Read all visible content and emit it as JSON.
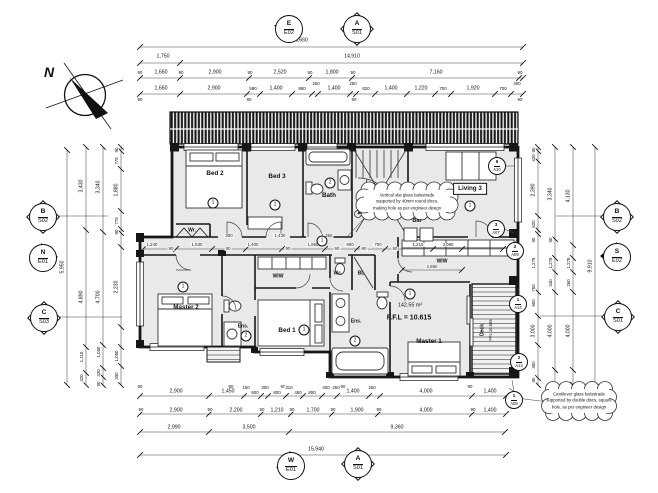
{
  "colors": {
    "paper": "#ffffff",
    "floor": "#e9eae8",
    "wall": "#161616",
    "dimline": "#444444"
  },
  "north_arrow": {
    "letter": "N"
  },
  "room_labels": [
    {
      "t": "N",
      "x": 49,
      "y": 72,
      "c": "north"
    },
    {
      "t": "Bed 2",
      "x": 215,
      "y": 174
    },
    {
      "t": "Bed 3",
      "x": 277,
      "y": 177
    },
    {
      "t": "Bath",
      "x": 329,
      "y": 196
    },
    {
      "t": "Living 3",
      "x": 470,
      "y": 189,
      "c": "boxed"
    },
    {
      "t": "Bar",
      "x": 417,
      "y": 222,
      "c": "bar"
    },
    {
      "t": "Wr.",
      "x": 192,
      "y": 231,
      "c": "tiny"
    },
    {
      "t": "Wc.",
      "x": 338,
      "y": 274,
      "c": "tiny"
    },
    {
      "t": "BL",
      "x": 361,
      "y": 274,
      "c": "tiny"
    },
    {
      "t": "WIW",
      "x": 278,
      "y": 277,
      "c": "tiny"
    },
    {
      "t": "WIW",
      "x": 442,
      "y": 262,
      "c": "tiny"
    },
    {
      "t": "Master 2",
      "x": 186,
      "y": 308
    },
    {
      "t": "Ens.",
      "x": 243,
      "y": 327,
      "c": "tiny"
    },
    {
      "t": "Bed 1",
      "x": 287,
      "y": 331
    },
    {
      "t": "Ens.",
      "x": 356,
      "y": 322,
      "c": "tiny"
    },
    {
      "t": "Master 1",
      "x": 429,
      "y": 342
    },
    {
      "t": "142.55 m²",
      "x": 410,
      "y": 306,
      "c": "area"
    },
    {
      "t": "F.F.L = 10.615",
      "x": 409,
      "y": 318,
      "c": "ffl"
    },
    {
      "t": "Deck",
      "x": 483,
      "y": 330,
      "r": -90,
      "c": "tiny"
    },
    {
      "t": "FFL 10.565",
      "x": 491,
      "y": 330,
      "r": -90,
      "c": "micro"
    }
  ],
  "circled_numbers": [
    {
      "n": "1",
      "x": 213,
      "y": 203
    },
    {
      "n": "1",
      "x": 275,
      "y": 205
    },
    {
      "n": "2",
      "x": 330,
      "y": 183
    },
    {
      "n": "1",
      "x": 470,
      "y": 206
    },
    {
      "n": "1",
      "x": 322,
      "y": 241
    },
    {
      "n": "1",
      "x": 183,
      "y": 287
    },
    {
      "n": "2",
      "x": 246,
      "y": 336
    },
    {
      "n": "1",
      "x": 304,
      "y": 330
    },
    {
      "n": "2",
      "x": 355,
      "y": 341
    },
    {
      "n": "1",
      "x": 410,
      "y": 294
    }
  ],
  "ref_tags": [
    {
      "n": "6",
      "s": "A10",
      "x": 497,
      "y": 166
    },
    {
      "n": "3",
      "s": "A07",
      "x": 496,
      "y": 229
    },
    {
      "n": "2",
      "s": "A09",
      "x": 515,
      "y": 251
    },
    {
      "n": "1",
      "s": "A14",
      "x": 518,
      "y": 304
    },
    {
      "n": "2",
      "s": "A13",
      "x": 519,
      "y": 362
    },
    {
      "n": "1",
      "s": "A08",
      "x": 514,
      "y": 400
    }
  ],
  "section_markers": [
    {
      "code": "E",
      "sheet": "E02",
      "x": 288,
      "y": 28,
      "type": "elev-down"
    },
    {
      "code": "A",
      "sheet": "S01",
      "x": 356,
      "y": 28,
      "type": "section"
    },
    {
      "code": "B",
      "sheet": "S02",
      "x": 42,
      "y": 216,
      "type": "section"
    },
    {
      "code": "N",
      "sheet": "E01",
      "x": 42,
      "y": 257,
      "type": "elev-right"
    },
    {
      "code": "C",
      "sheet": "S03",
      "x": 43,
      "y": 317,
      "type": "section"
    },
    {
      "code": "B",
      "sheet": "S02",
      "x": 616,
      "y": 216,
      "type": "section"
    },
    {
      "code": "S",
      "sheet": "E02",
      "x": 616,
      "y": 256,
      "type": "elev-left"
    },
    {
      "code": "C",
      "sheet": "S01",
      "x": 617,
      "y": 316,
      "type": "section"
    },
    {
      "code": "W",
      "sheet": "E01",
      "x": 290,
      "y": 465,
      "type": "elev-up"
    },
    {
      "code": "A",
      "sheet": "S01",
      "x": 357,
      "y": 463,
      "type": "section"
    }
  ],
  "notes": [
    {
      "x": 407,
      "y": 202,
      "lines": [
        "Vertical slat glass balustrade",
        "supported by 40mm round discs,",
        "making hole as per engineer design"
      ]
    },
    {
      "x": 579,
      "y": 401,
      "lines": [
        "Cantilever glass balustrade",
        "supported by double discs, square",
        "hole, as per engineer design"
      ]
    }
  ],
  "dims": [
    {
      "t": "16,660",
      "x": 300,
      "y": 41
    },
    {
      "t": "1,750",
      "x": 163,
      "y": 57
    },
    {
      "t": "14,910",
      "x": 352,
      "y": 57
    },
    {
      "t": "90",
      "x": 140,
      "y": 73,
      "c": "micro"
    },
    {
      "t": "1,660",
      "x": 161,
      "y": 73
    },
    {
      "t": "90",
      "x": 181,
      "y": 73,
      "c": "micro"
    },
    {
      "t": "2,900",
      "x": 215,
      "y": 73
    },
    {
      "t": "90",
      "x": 250,
      "y": 73,
      "c": "micro"
    },
    {
      "t": "2,520",
      "x": 280,
      "y": 73
    },
    {
      "t": "90",
      "x": 310,
      "y": 73,
      "c": "micro"
    },
    {
      "t": "1,800",
      "x": 332,
      "y": 73
    },
    {
      "t": "90",
      "x": 353,
      "y": 73,
      "c": "micro"
    },
    {
      "t": "7,160",
      "x": 436,
      "y": 73
    },
    {
      "t": "90",
      "x": 520,
      "y": 73,
      "c": "micro"
    },
    {
      "t": "1,660",
      "x": 161,
      "y": 89
    },
    {
      "t": "2,900",
      "x": 214,
      "y": 89
    },
    {
      "t": "580",
      "x": 253,
      "y": 89,
      "c": "micro"
    },
    {
      "t": "1,400",
      "x": 276,
      "y": 89
    },
    {
      "t": "880",
      "x": 302,
      "y": 89,
      "c": "micro"
    },
    {
      "t": "250",
      "x": 316,
      "y": 84,
      "c": "micro"
    },
    {
      "t": "1,400",
      "x": 334,
      "y": 89
    },
    {
      "t": "250",
      "x": 353,
      "y": 84,
      "c": "micro"
    },
    {
      "t": "820",
      "x": 366,
      "y": 89,
      "c": "micro"
    },
    {
      "t": "1,400",
      "x": 391,
      "y": 89
    },
    {
      "t": "1,220",
      "x": 421,
      "y": 89
    },
    {
      "t": "700",
      "x": 443,
      "y": 89,
      "c": "micro"
    },
    {
      "t": "1,920",
      "x": 473,
      "y": 89
    },
    {
      "t": "700",
      "x": 503,
      "y": 89,
      "c": "micro"
    },
    {
      "t": "400",
      "x": 517,
      "y": 84,
      "c": "micro"
    },
    {
      "t": "90",
      "x": 140,
      "y": 100,
      "c": "micro"
    },
    {
      "t": "90",
      "x": 249,
      "y": 100,
      "c": "micro"
    },
    {
      "t": "90",
      "x": 354,
      "y": 100,
      "c": "micro"
    },
    {
      "t": "90",
      "x": 520,
      "y": 100,
      "c": "micro"
    },
    {
      "t": "1,240",
      "x": 152,
      "y": 245,
      "c": "micro"
    },
    {
      "t": "90",
      "x": 171,
      "y": 249,
      "c": "micro"
    },
    {
      "t": "1,530",
      "x": 197,
      "y": 245,
      "c": "micro"
    },
    {
      "t": "90",
      "x": 228,
      "y": 249,
      "c": "micro"
    },
    {
      "t": "1,400",
      "x": 253,
      "y": 245,
      "c": "micro"
    },
    {
      "t": "90",
      "x": 288,
      "y": 249,
      "c": "micro"
    },
    {
      "t": "1,860",
      "x": 313,
      "y": 245,
      "c": "micro"
    },
    {
      "t": "90",
      "x": 337,
      "y": 249,
      "c": "micro"
    },
    {
      "t": "900",
      "x": 350,
      "y": 245,
      "c": "micro"
    },
    {
      "t": "90",
      "x": 364,
      "y": 249,
      "c": "micro"
    },
    {
      "t": "700",
      "x": 378,
      "y": 245,
      "c": "micro"
    },
    {
      "t": "90",
      "x": 395,
      "y": 249,
      "c": "micro"
    },
    {
      "t": "1,210",
      "x": 418,
      "y": 245,
      "c": "micro"
    },
    {
      "t": "3,090",
      "x": 448,
      "y": 245,
      "c": "micro"
    },
    {
      "t": "300",
      "x": 229,
      "y": 236,
      "c": "micro"
    },
    {
      "t": "1,430",
      "x": 280,
      "y": 236,
      "c": "micro"
    },
    {
      "t": "1,360",
      "x": 327,
      "y": 236,
      "c": "micro"
    },
    {
      "t": "2,860",
      "x": 432,
      "y": 267,
      "c": "micro"
    },
    {
      "t": "90",
      "x": 140,
      "y": 387,
      "c": "micro"
    },
    {
      "t": "90",
      "x": 231,
      "y": 387,
      "c": "micro"
    },
    {
      "t": "90",
      "x": 283,
      "y": 387,
      "c": "micro"
    },
    {
      "t": "90",
      "x": 343,
      "y": 387,
      "c": "micro"
    },
    {
      "t": "90",
      "x": 470,
      "y": 387,
      "c": "micro"
    },
    {
      "t": "2,900",
      "x": 176,
      "y": 392
    },
    {
      "t": "1,450",
      "x": 228,
      "y": 392
    },
    {
      "t": "150",
      "x": 246,
      "y": 388,
      "c": "micro"
    },
    {
      "t": "600",
      "x": 255,
      "y": 393,
      "c": "micro"
    },
    {
      "t": "300",
      "x": 265,
      "y": 388,
      "c": "micro"
    },
    {
      "t": "800",
      "x": 277,
      "y": 393,
      "c": "micro"
    },
    {
      "t": "310",
      "x": 289,
      "y": 388,
      "c": "micro"
    },
    {
      "t": "450",
      "x": 298,
      "y": 393,
      "c": "micro"
    },
    {
      "t": "800",
      "x": 312,
      "y": 393,
      "c": "micro"
    },
    {
      "t": "400",
      "x": 326,
      "y": 388,
      "c": "micro"
    },
    {
      "t": "250",
      "x": 336,
      "y": 388,
      "c": "micro"
    },
    {
      "t": "1,400",
      "x": 353,
      "y": 392
    },
    {
      "t": "250",
      "x": 372,
      "y": 388,
      "c": "micro"
    },
    {
      "t": "4,000",
      "x": 426,
      "y": 392
    },
    {
      "t": "1,400",
      "x": 490,
      "y": 392
    },
    {
      "t": "90",
      "x": 141,
      "y": 410,
      "c": "micro"
    },
    {
      "t": "2,900",
      "x": 176,
      "y": 411
    },
    {
      "t": "90",
      "x": 210,
      "y": 410,
      "c": "micro"
    },
    {
      "t": "2,200",
      "x": 236,
      "y": 411
    },
    {
      "t": "90",
      "x": 262,
      "y": 410,
      "c": "micro"
    },
    {
      "t": "1,210",
      "x": 277,
      "y": 411
    },
    {
      "t": "90",
      "x": 292,
      "y": 410,
      "c": "micro"
    },
    {
      "t": "1,700",
      "x": 313,
      "y": 411
    },
    {
      "t": "90",
      "x": 333,
      "y": 410,
      "c": "micro"
    },
    {
      "t": "1,900",
      "x": 357,
      "y": 411
    },
    {
      "t": "90",
      "x": 379,
      "y": 410,
      "c": "micro"
    },
    {
      "t": "4,000",
      "x": 426,
      "y": 411
    },
    {
      "t": "90",
      "x": 473,
      "y": 410,
      "c": "micro"
    },
    {
      "t": "1,400",
      "x": 490,
      "y": 411
    },
    {
      "t": "2,990",
      "x": 174,
      "y": 428
    },
    {
      "t": "3,500",
      "x": 249,
      "y": 428
    },
    {
      "t": "9,360",
      "x": 397,
      "y": 428
    },
    {
      "t": "15,940",
      "x": 316,
      "y": 450
    },
    {
      "t": "5,950",
      "x": 63,
      "y": 267,
      "r": -90
    },
    {
      "t": "3,430",
      "x": 82,
      "y": 186,
      "r": -90
    },
    {
      "t": "4,890",
      "x": 82,
      "y": 297,
      "r": -90
    },
    {
      "t": "1,110",
      "x": 82,
      "y": 357,
      "r": -90,
      "c": "micro"
    },
    {
      "t": "420",
      "x": 82,
      "y": 378,
      "r": -90,
      "c": "micro"
    },
    {
      "t": "3,340",
      "x": 99,
      "y": 187,
      "r": -90
    },
    {
      "t": "4,700",
      "x": 99,
      "y": 297,
      "r": -90
    },
    {
      "t": "1,050",
      "x": 99,
      "y": 352,
      "r": -90,
      "c": "micro"
    },
    {
      "t": "330",
      "x": 99,
      "y": 373,
      "r": -90,
      "c": "micro"
    },
    {
      "t": "90",
      "x": 99,
      "y": 384,
      "r": -90,
      "c": "micro"
    },
    {
      "t": "90",
      "x": 117,
      "y": 150,
      "r": -90,
      "c": "micro"
    },
    {
      "t": "775",
      "x": 117,
      "y": 161,
      "r": -90,
      "c": "micro"
    },
    {
      "t": "1,880",
      "x": 117,
      "y": 190,
      "r": -90
    },
    {
      "t": "775",
      "x": 117,
      "y": 221,
      "r": -90,
      "c": "micro"
    },
    {
      "t": "90",
      "x": 117,
      "y": 232,
      "r": -90,
      "c": "micro"
    },
    {
      "t": "2,230",
      "x": 117,
      "y": 287,
      "r": -90
    },
    {
      "t": "1,050",
      "x": 117,
      "y": 356,
      "r": -90,
      "c": "micro"
    },
    {
      "t": "390",
      "x": 117,
      "y": 376,
      "r": -90,
      "c": "micro"
    },
    {
      "t": "90",
      "x": 534,
      "y": 150,
      "r": -90,
      "c": "micro"
    },
    {
      "t": "420",
      "x": 534,
      "y": 158,
      "r": -90,
      "c": "micro"
    },
    {
      "t": "2,390",
      "x": 534,
      "y": 190,
      "r": -90
    },
    {
      "t": "620",
      "x": 534,
      "y": 224,
      "r": -90,
      "c": "micro"
    },
    {
      "t": "90",
      "x": 534,
      "y": 240,
      "r": -90,
      "c": "micro"
    },
    {
      "t": "1,278",
      "x": 534,
      "y": 263,
      "r": -90,
      "c": "micro"
    },
    {
      "t": "760",
      "x": 534,
      "y": 288,
      "r": -90,
      "c": "micro"
    },
    {
      "t": "500",
      "x": 534,
      "y": 303,
      "r": -90,
      "c": "micro"
    },
    {
      "t": "3,000",
      "x": 534,
      "y": 331,
      "r": -90
    },
    {
      "t": "300",
      "x": 534,
      "y": 365,
      "r": -90,
      "c": "micro"
    },
    {
      "t": "90",
      "x": 534,
      "y": 380,
      "r": -90,
      "c": "micro"
    },
    {
      "t": "3,340",
      "x": 551,
      "y": 194,
      "r": -90
    },
    {
      "t": "90",
      "x": 551,
      "y": 240,
      "r": -90,
      "c": "micro"
    },
    {
      "t": "1,278",
      "x": 551,
      "y": 263,
      "r": -90,
      "c": "micro"
    },
    {
      "t": "340",
      "x": 551,
      "y": 283,
      "r": -90,
      "c": "micro"
    },
    {
      "t": "4,000",
      "x": 551,
      "y": 331,
      "r": -90
    },
    {
      "t": "4,130",
      "x": 569,
      "y": 196,
      "r": -90
    },
    {
      "t": "1,278",
      "x": 569,
      "y": 263,
      "r": -90,
      "c": "micro"
    },
    {
      "t": "260",
      "x": 569,
      "y": 283,
      "r": -90,
      "c": "micro"
    },
    {
      "t": "4,000",
      "x": 569,
      "y": 331,
      "r": -90
    },
    {
      "t": "9,910",
      "x": 591,
      "y": 266,
      "r": -90
    }
  ]
}
